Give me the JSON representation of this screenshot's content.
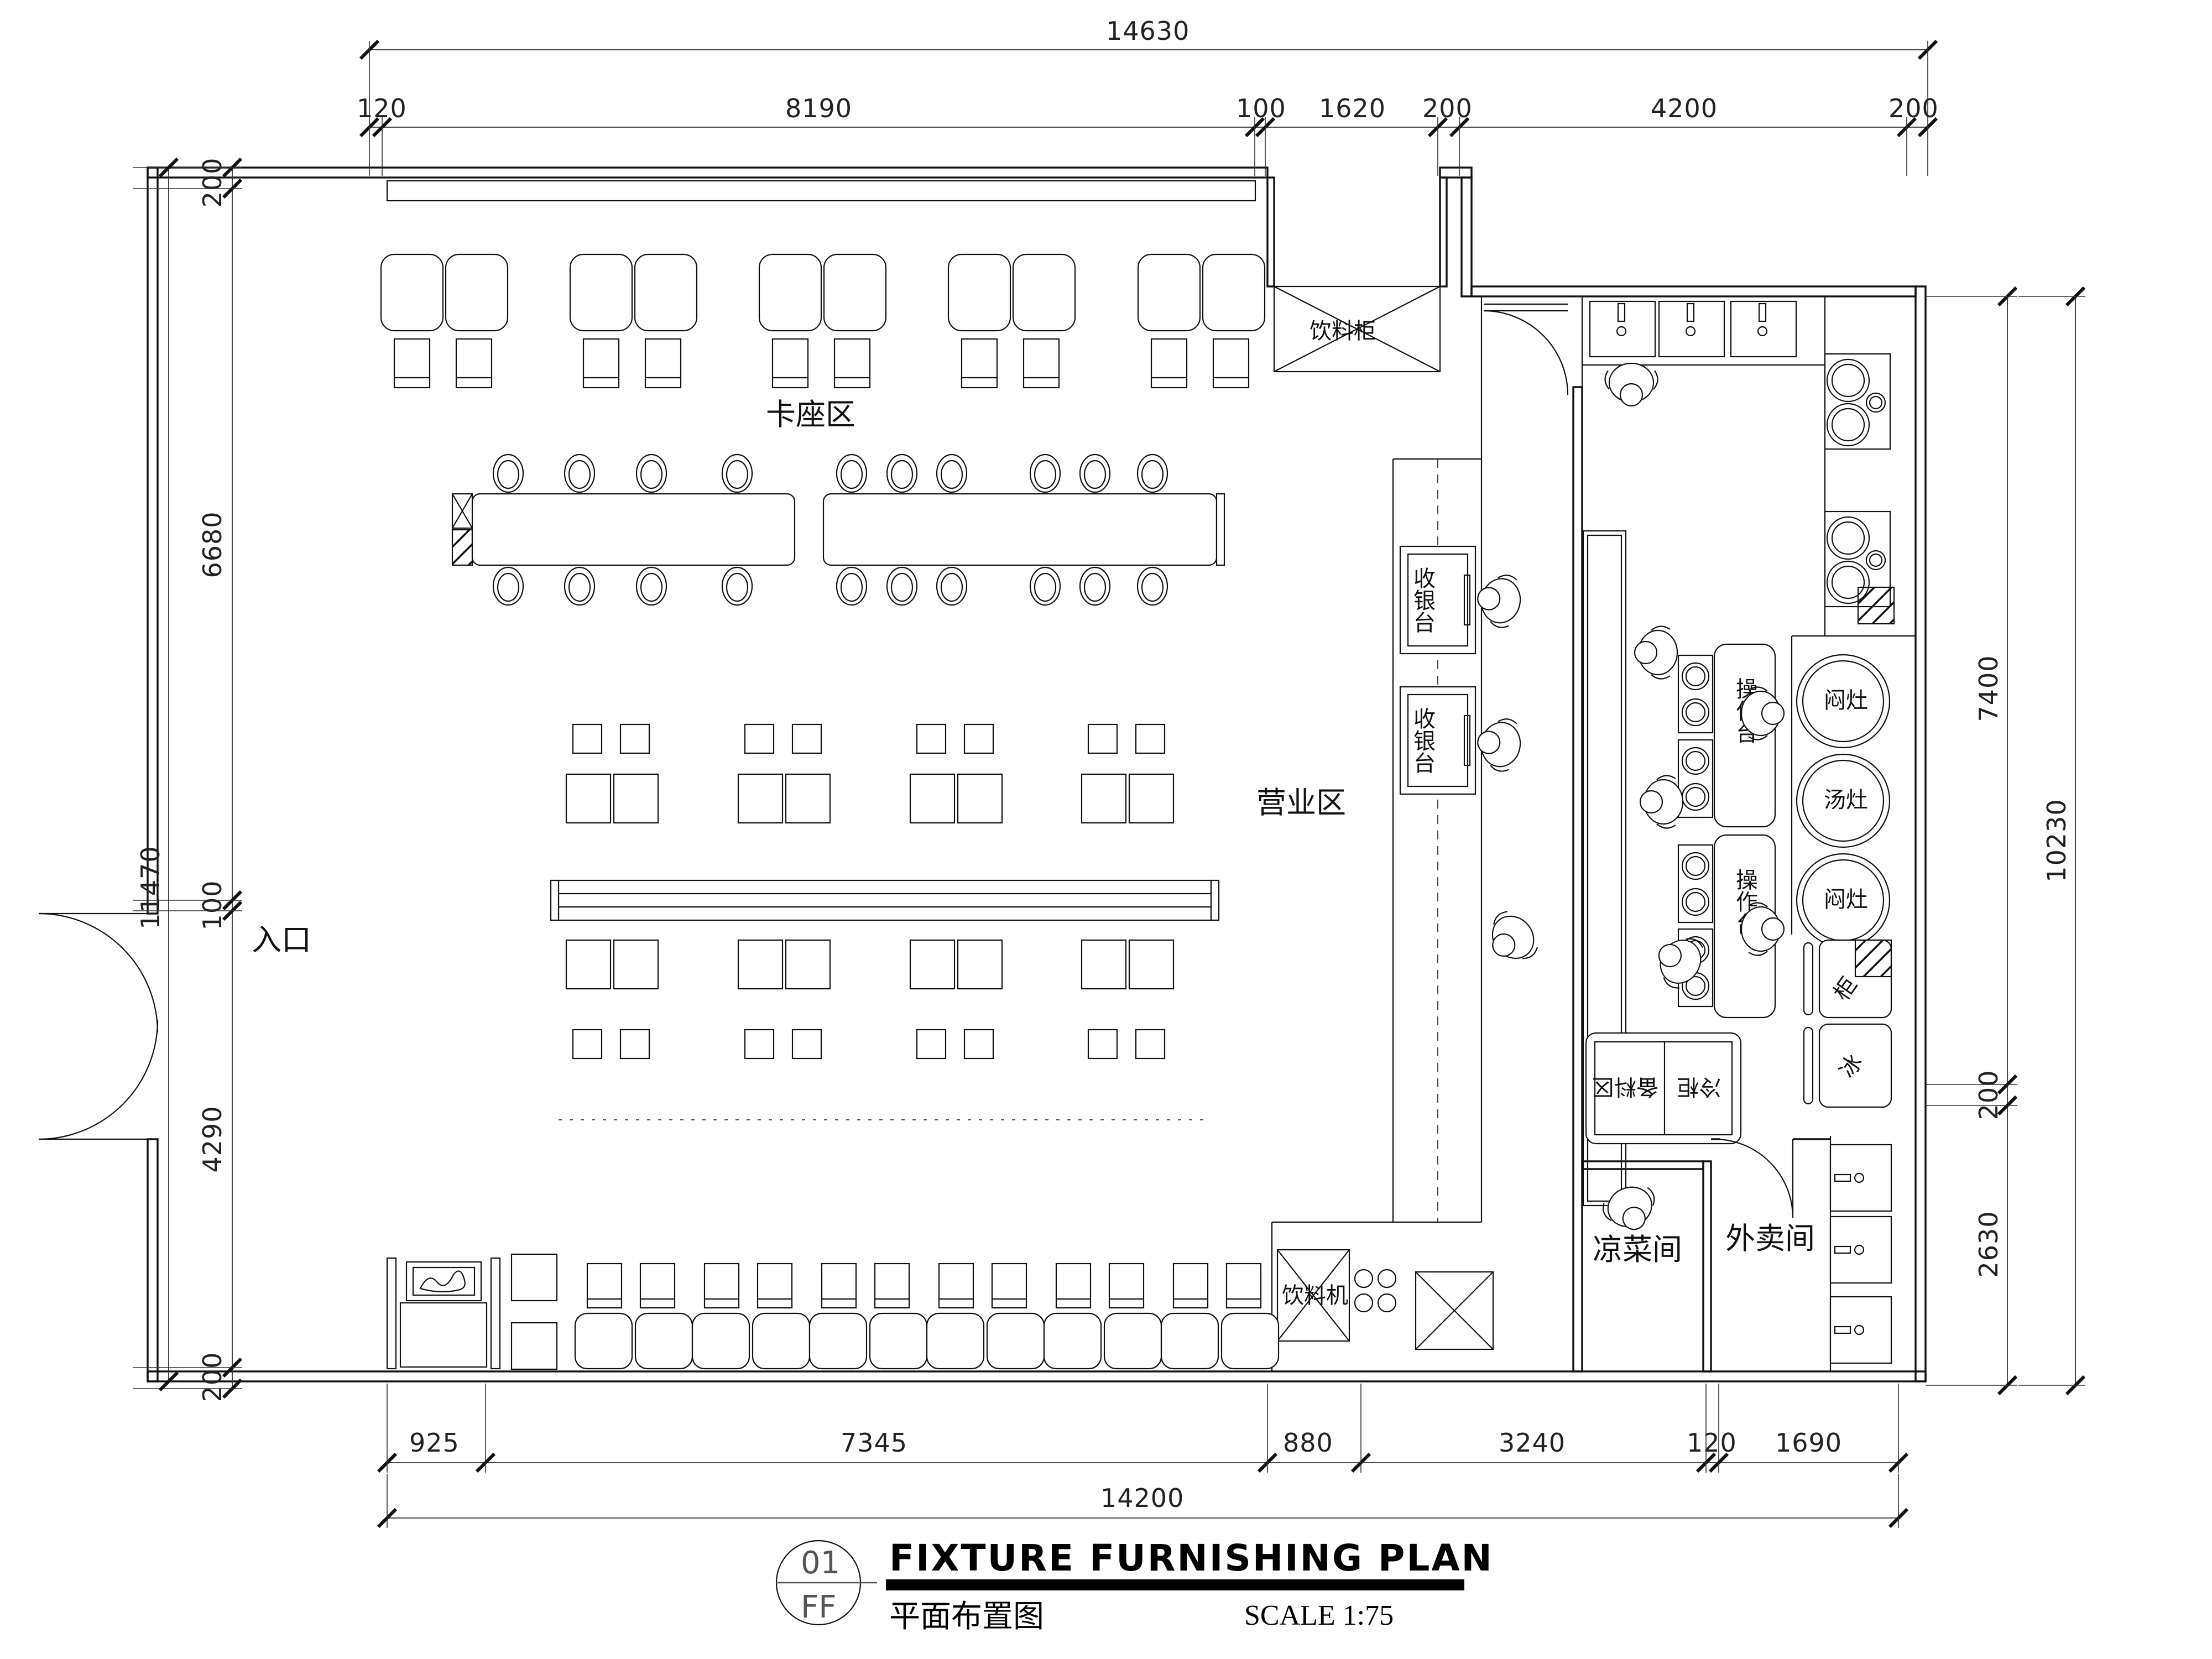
{
  "title_block": {
    "sheet_no": "01",
    "sheet_code": "FF",
    "title_en": "FIXTURE FURNISHING PLAN",
    "title_cn": "平面布置图",
    "scale": "SCALE 1:75"
  },
  "areas": {
    "booth_zone": "卡座区",
    "dining_zone": "营业区",
    "entrance": "入口",
    "cold_dish_room": "凉菜间",
    "takeout_room": "外卖间"
  },
  "fixtures": {
    "beverage_cabinet": "饮料柜",
    "dish_sink": "洗碗盆",
    "cashier_1": "收银台",
    "cashier_2": "收银台",
    "worktop_1": "操作台",
    "worktop_2": "操作台",
    "stove_top": "闷灶",
    "stove_mid": "汤灶",
    "stove_bottom": "闷灶",
    "prep_area": "备料区",
    "cold_cabinet": "冷柜",
    "cabinet_char": "柜",
    "ice_char": "冰",
    "beverage_machine": "饮料机"
  },
  "dims": {
    "top": {
      "total": "14630",
      "segments": [
        "120",
        "8190",
        "100",
        "1620",
        "200",
        "4200",
        "200"
      ]
    },
    "left": {
      "total": "11470",
      "segments": [
        "200",
        "6680",
        "100",
        "4290",
        "200"
      ]
    },
    "right": {
      "outer_total": "10230",
      "segments": [
        "7400",
        "200",
        "2630"
      ]
    },
    "bottom": {
      "total": "14200",
      "segments": [
        "925",
        "7345",
        "880",
        "3240",
        "120",
        "1690"
      ]
    }
  }
}
